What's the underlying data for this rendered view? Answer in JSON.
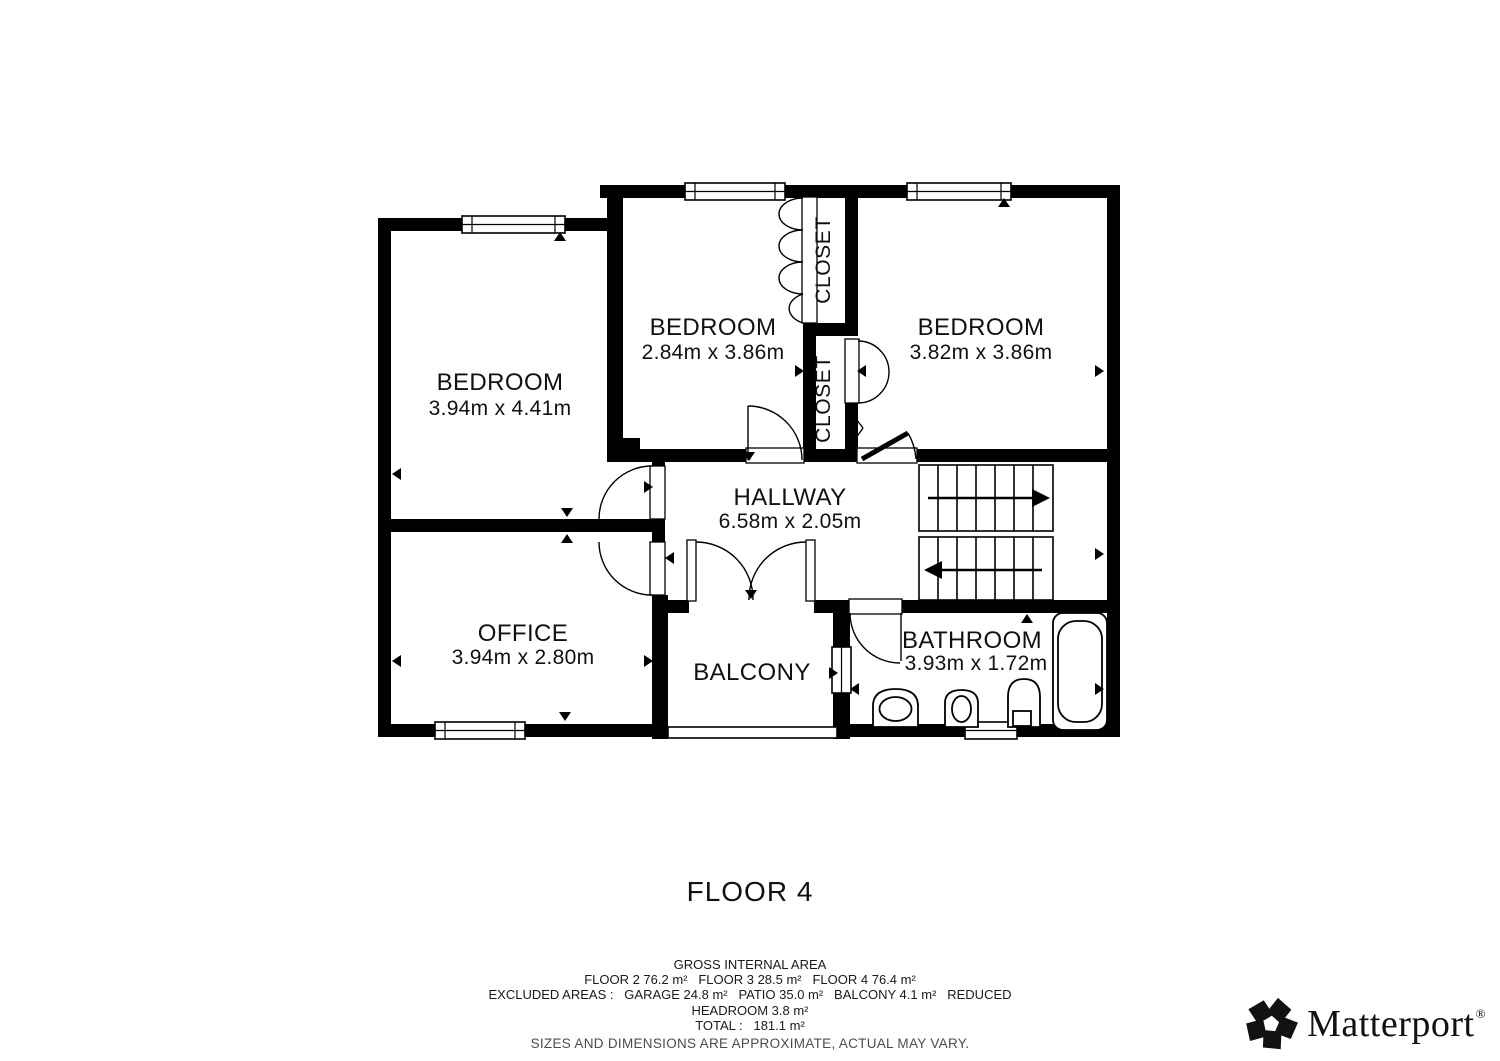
{
  "floor_plan": {
    "title": "FLOOR 4",
    "rooms": [
      {
        "name": "BEDROOM",
        "dimensions": "3.94m x 4.41m"
      },
      {
        "name": "BEDROOM",
        "dimensions": "2.84m x 3.86m"
      },
      {
        "name": "BEDROOM",
        "dimensions": "3.82m x 3.86m"
      },
      {
        "name": "HALLWAY",
        "dimensions": "6.58m x 2.05m"
      },
      {
        "name": "OFFICE",
        "dimensions": "3.94m x 2.80m"
      },
      {
        "name": "BALCONY",
        "dimensions": ""
      },
      {
        "name": "BATHROOM",
        "dimensions": "3.93m x 1.72m"
      }
    ],
    "closets": [
      {
        "label": "CLOSET"
      },
      {
        "label": "CLOSET"
      }
    ]
  },
  "footer": {
    "heading": "GROSS INTERNAL AREA",
    "line_floors": "FLOOR 2 76.2 m²   FLOOR 3 28.5 m²   FLOOR 4 76.4 m²",
    "line_excluded": "EXCLUDED AREAS :   GARAGE 24.8 m²   PATIO 35.0 m²   BALCONY 4.1 m²   REDUCED",
    "line_headroom": "HEADROOM 3.8 m²",
    "line_total": "TOTAL :   181.1 m²",
    "disclaimer": "SIZES AND DIMENSIONS ARE APPROXIMATE, ACTUAL MAY VARY."
  },
  "branding": {
    "logo_text": "Matterport",
    "registered_mark": "®"
  },
  "colors": {
    "wall": "#000000",
    "background": "#ffffff",
    "disclaimer_gray": "#4c4c4c"
  }
}
